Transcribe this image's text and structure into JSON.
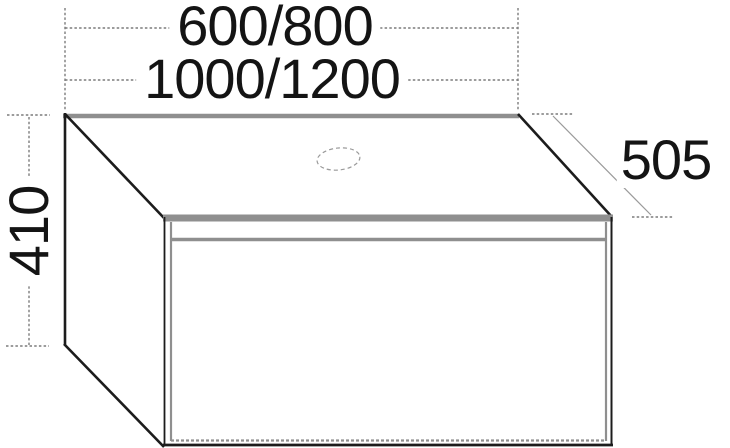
{
  "drawing": {
    "labels": {
      "width_variants_line1": "600/800",
      "width_variants_line2": "1000/1200",
      "height": "410",
      "depth": "505"
    },
    "colors": {
      "background": "#ffffff",
      "outline_dark": "#1c1c1c",
      "outline_gray": "#8f8f8f",
      "dimension_line": "#7c7c7c",
      "label_text": "#141414"
    }
  }
}
